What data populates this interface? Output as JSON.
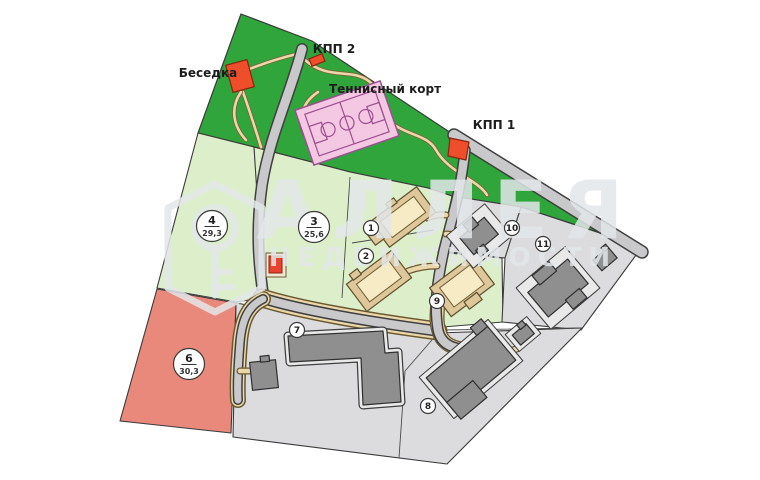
{
  "map": {
    "type": "cottage-community-master-plan",
    "labels": {
      "gazebo": "Беседка",
      "checkpoint_2": "КПП 2",
      "tennis_court": "Теннисный корт",
      "checkpoint_1": "КПП 1"
    },
    "plots": [
      {
        "id": "1"
      },
      {
        "id": "2"
      },
      {
        "id": "3",
        "area": "25,6"
      },
      {
        "id": "4",
        "area": "29,3"
      },
      {
        "id": "6",
        "area": "30,3"
      },
      {
        "id": "7"
      },
      {
        "id": "8"
      },
      {
        "id": "9"
      },
      {
        "id": "10"
      },
      {
        "id": "11"
      }
    ],
    "watermark": {
      "brand": "АЛЛЕЯ",
      "brand_sub": "НЕДВИЖИМОСТИ"
    },
    "colors": {
      "forest_green": "#2fa53c",
      "plot_green": "#dcefca",
      "plot_gray": "#dcdcde",
      "plot_red": "#e8897c",
      "road_gray": "#c9c9cc",
      "path_tan": "#ead8ab",
      "building_gray": "#8f8f90",
      "house_cream": "#f6ebc4",
      "house_tan": "#ddc79b",
      "court_pink": "#f4c8e3",
      "structure_red": "#ee4e2a"
    }
  }
}
